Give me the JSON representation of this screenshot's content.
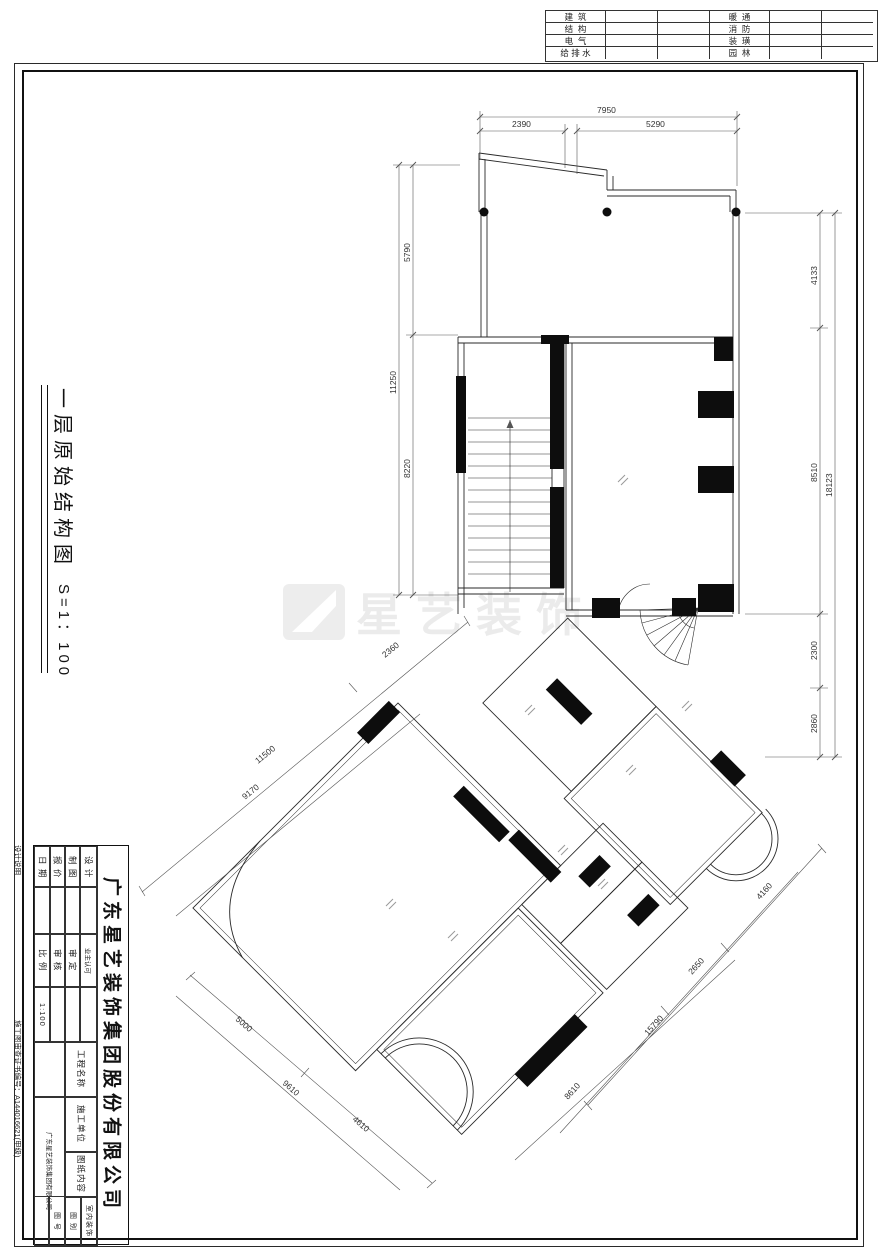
{
  "top_table": {
    "rows": [
      {
        "l": "建  筑",
        "r": "暖  通"
      },
      {
        "l": "结  构",
        "r": "消  防"
      },
      {
        "l": "电  气",
        "r": "装  璜"
      },
      {
        "l": "给 排 水",
        "r": "园  林"
      }
    ]
  },
  "side_title": {
    "text": "一层原始结构图",
    "scale": "S=1：100"
  },
  "notes": {
    "top": "设计说明",
    "bottom": "施工图审查证书编号：A144016621(甲级)"
  },
  "watermark": {
    "text": "星艺装饰"
  },
  "title_block": {
    "company": "广东星艺装饰集团股份有限公司",
    "cols": [
      {
        "l1": "日 期",
        "l2": "比 例",
        "v": "1:100"
      },
      {
        "l1": "报 价",
        "l2": "审 核",
        "v": ""
      },
      {
        "l1": "制 图",
        "l2": "审 定",
        "v": ""
      },
      {
        "l1": "设 计",
        "l2": "业主认可",
        "v": ""
      }
    ],
    "project_label": "工程名称",
    "contractor_label": "施工单位",
    "contractor_value": "广东星艺装饰集团有限公司",
    "content_label": "图纸内容",
    "category_label": "图 别",
    "category_value": "室内装饰",
    "number_label": "图 号"
  },
  "dims": {
    "top_total": "7950",
    "top_a": "2390",
    "top_b": "5290",
    "right_total": "18123",
    "right_a": "4133",
    "right_b": "8510",
    "right_c": "2300",
    "right_d": "2860",
    "left_total": "11250",
    "left_a": "5790",
    "left_b": "8220",
    "nw_a": "2360",
    "nw_b": "11500",
    "nw_c": "9170",
    "sw_a": "5000",
    "sw_b": "9610",
    "sw_c": "4610",
    "se_a": "4160",
    "se_b": "2650",
    "se_c": "15790",
    "se_d": "8610"
  }
}
